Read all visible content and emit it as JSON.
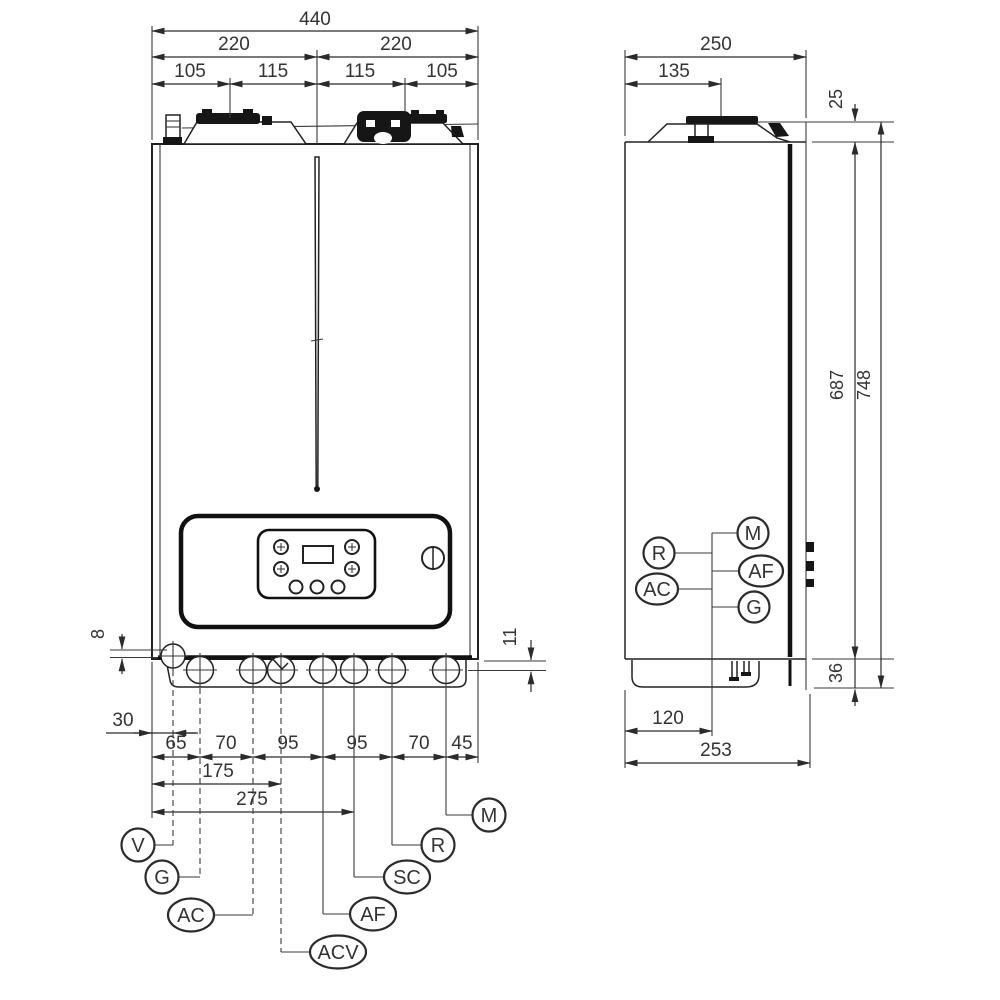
{
  "front_view": {
    "dims": {
      "total_width": "440",
      "half_left": "220",
      "half_right": "220",
      "quarters": [
        "105",
        "115",
        "115",
        "105"
      ],
      "left_offset": "8",
      "right_offset": "11",
      "v_offset": "30",
      "chain": [
        "65",
        "70",
        "95",
        "95",
        "70",
        "45"
      ],
      "to_acv": "175",
      "to_sc": "275"
    },
    "connections": [
      {
        "label": "V"
      },
      {
        "label": "G"
      },
      {
        "label": "AC"
      },
      {
        "label": "ACV"
      },
      {
        "label": "AF"
      },
      {
        "label": "SC"
      },
      {
        "label": "R"
      },
      {
        "label": "M"
      }
    ]
  },
  "side_view": {
    "dims": {
      "depth": "250",
      "flue_center": "135",
      "top_clearance": "25",
      "body_height": "687",
      "total_height": "748",
      "bottom_clearance": "36",
      "connection_offset": "120",
      "base_depth": "253"
    },
    "connections_left": [
      {
        "label": "R"
      },
      {
        "label": "AC"
      }
    ],
    "connections_right": [
      {
        "label": "M"
      },
      {
        "label": "AF"
      },
      {
        "label": "G"
      }
    ]
  }
}
